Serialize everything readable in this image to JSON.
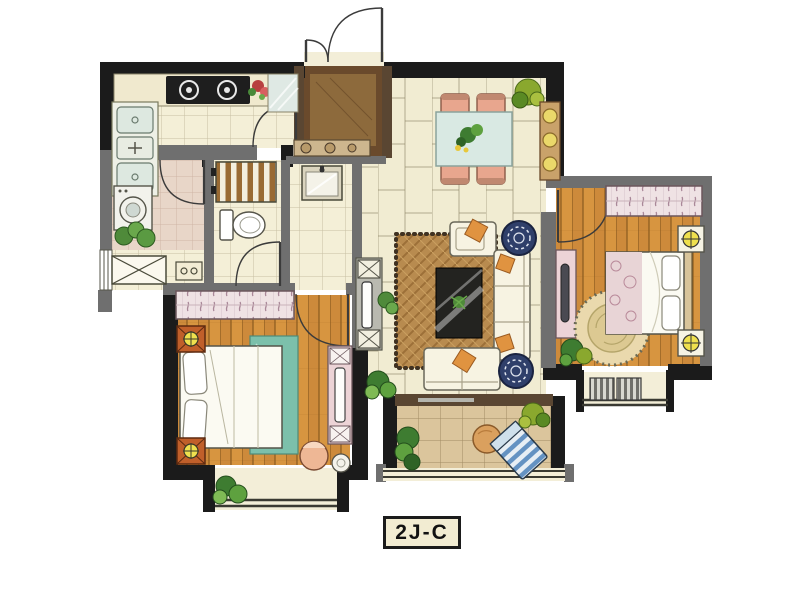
{
  "plan": {
    "label": "2J-C",
    "type": "residential-apartment-floorplan",
    "rooms": [
      "kitchen",
      "entry-foyer",
      "dining-area",
      "living-room",
      "hallway",
      "bathroom-laundry",
      "wc-shower",
      "master-bedroom",
      "second-bedroom",
      "south-balcony",
      "master-bay-window",
      "second-bay-window"
    ],
    "furniture": [
      "gas-stove",
      "double-kitchen-sink",
      "glass-counter",
      "washing-machine",
      "bathtub-fixture",
      "toilet",
      "shower-slats",
      "wash-basin",
      "shoe-console",
      "dining-table-4-chairs",
      "sideboard-with-plates",
      "tv-stand",
      "area-rug",
      "coffee-table",
      "armchair",
      "three-seat-sofa",
      "loveseat",
      "round-side-tables",
      "orange-cushions",
      "master-double-bed",
      "teal-bed-throw",
      "wardrobes",
      "orange-nightstands-with-lamps",
      "dresser-with-tv",
      "corner-chair",
      "stool",
      "second-double-bed",
      "white-nightstands-with-lamps",
      "round-rug",
      "bedroom-bench",
      "patio-round-table",
      "striped-lounge-chair",
      "air-conditioner-units",
      "potted-plants"
    ],
    "colors": {
      "background": "#ffffff",
      "wall_structural": "#1b1b1b",
      "wall_partition": "#6f6f6f",
      "floor_tile_cream": "#f1ecd2",
      "floor_wood_plank": "#cf8d3c",
      "floor_balcony_tile": "#dcc69e",
      "floor_bath_pink": "#e8d6c8",
      "foyer_dark_wood": "#6a4a2c",
      "accent_teal_bedding": "#7cc0ab",
      "accent_orange_cushion": "#e09340",
      "accent_navy_side_table": "#2f3f6a",
      "accent_lamp_yellow": "#efe04e",
      "label_background": "#f2ecd2"
    }
  }
}
